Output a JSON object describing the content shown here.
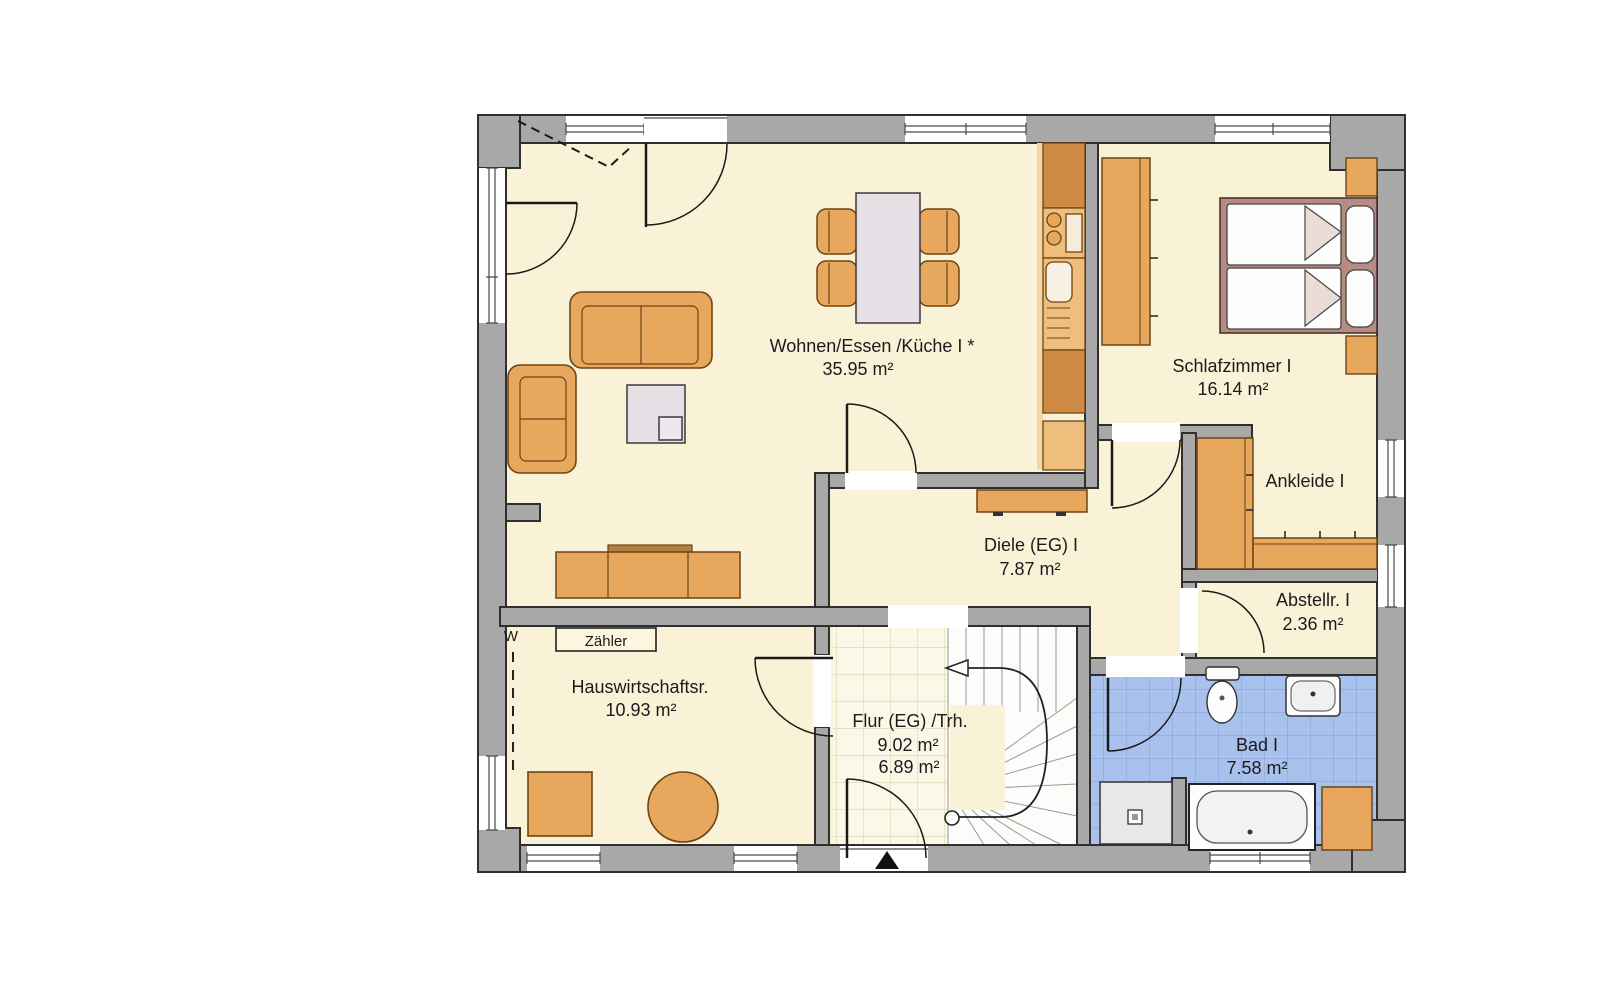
{
  "plan": {
    "type": "floor-plan-ground-floor",
    "rooms": [
      {
        "name": "Wohnen/Essen /Küche I *",
        "area": "35.95 m²"
      },
      {
        "name": "Schlafzimmer I",
        "area": "16.14 m²"
      },
      {
        "name": "Ankleide I",
        "area": ""
      },
      {
        "name": "Abstellr. I",
        "area": "2.36 m²"
      },
      {
        "name": "Diele (EG) I",
        "area": "7.87 m²"
      },
      {
        "name": "Hauswirtschaftsr.",
        "area": "10.93 m²"
      },
      {
        "name": "Flur (EG) /Trh.",
        "area": "9.02 m²",
        "area_alt": "6.89 m²"
      },
      {
        "name": "Bad I",
        "area": "7.58 m²"
      }
    ],
    "labels": {
      "meter": "Zähler",
      "washer": "W"
    },
    "colors": {
      "wall": "#A8A8A8",
      "wall_outline": "#2F2F2F",
      "floor": "#FAF2D7",
      "flur_tile_bg": "#FCF8E8",
      "flur_tile_line": "#DCD5AF",
      "bad_tile_bg": "#A9C2ED",
      "bad_tile_line": "#8CA4D9",
      "furniture": "#E7A75D",
      "furniture_dark": "#CE8B45",
      "bed_frame": "#B68C82",
      "shower": "#E8E8E8"
    }
  }
}
